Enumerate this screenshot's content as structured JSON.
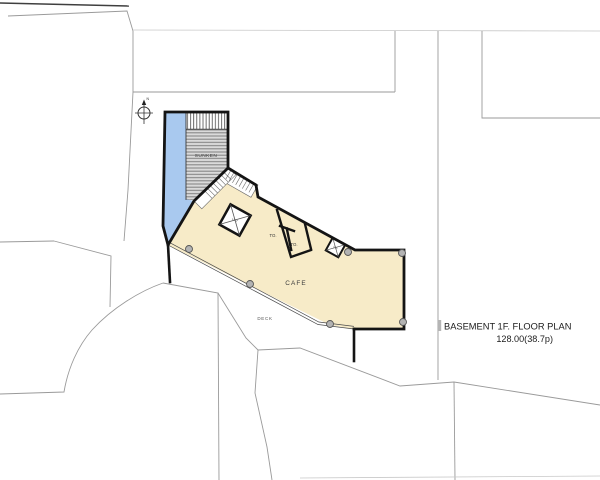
{
  "page": {
    "background": "#ffffff"
  },
  "title_block": {
    "title": "BASEMENT 1F. FLOOR PLAN",
    "area": "128.00(38.7p)"
  },
  "plan": {
    "labels": {
      "sunken": "SUNKEN",
      "cafe": "CAFE",
      "deck": "DECK",
      "toilet_1": "TO.",
      "toilet_2": "TO.",
      "lift": "LIFT",
      "dumbwaiter": "DW",
      "north": "N"
    },
    "colors": {
      "lightwell_blue": "#a9c9ef",
      "cafe_cream": "#f7ebc8",
      "sunken_gray": "#d9d9d9",
      "wall_black": "#141414",
      "site_line": "#9a9a9a",
      "column_fill": "#b3b3b3"
    }
  }
}
